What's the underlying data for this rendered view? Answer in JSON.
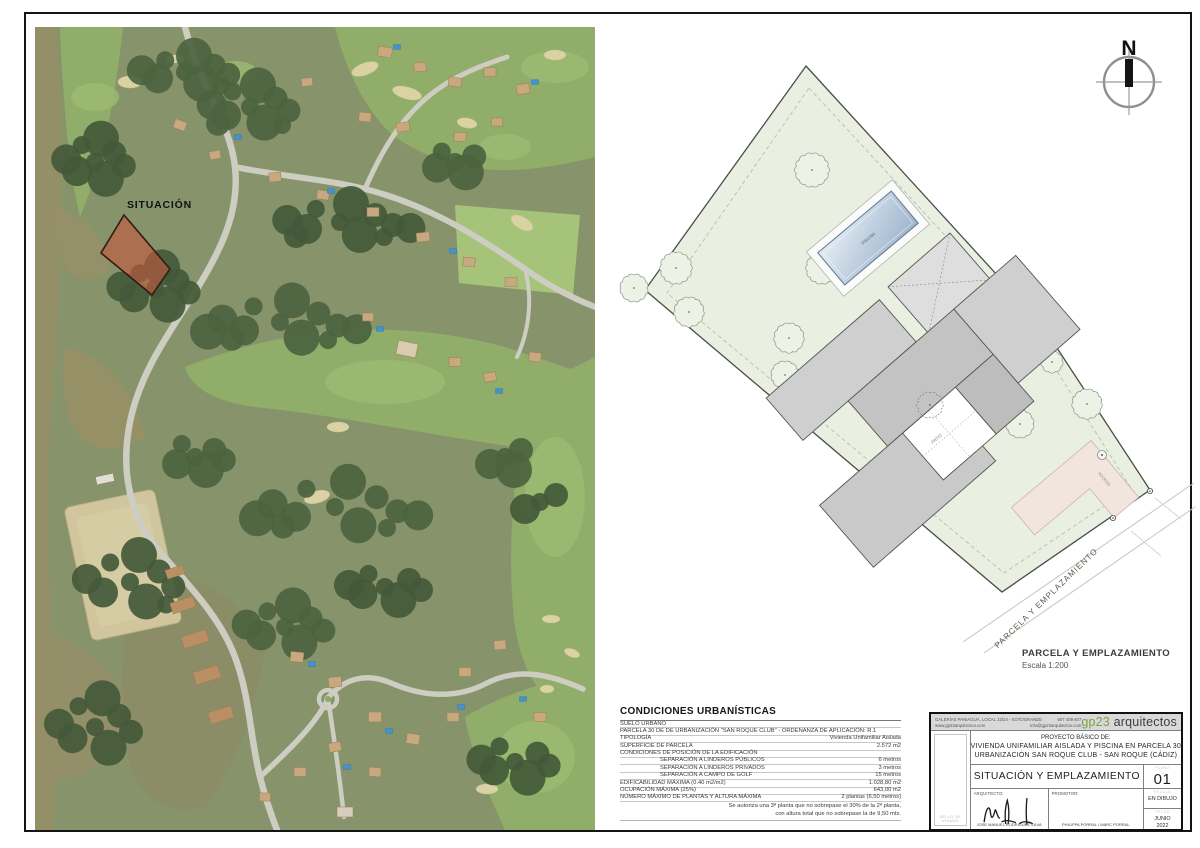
{
  "north": {
    "label": "N"
  },
  "aerial": {
    "situacion_label": "SITUACIÓN"
  },
  "plan": {
    "piscina_label": "PISCINA",
    "patio_label": "PATIO",
    "acceso_label": "ACCESO",
    "road_label": "PARCELA Y EMPLAZAMIENTO",
    "caption_title": "PARCELA Y EMPLAZAMIENTO",
    "caption_scale": "Escala 1:200"
  },
  "conditions": {
    "title": "CONDICIONES URBANÍSTICAS",
    "rows": [
      {
        "label": "SUELO URBANO",
        "value": "",
        "indent": false
      },
      {
        "label": "PARCELA 30 DE DE URBANIZACIÓN \"SAN ROQUE CLUB\"  -  ORDENANZA DE APLICACIÓN: R.1",
        "value": "",
        "indent": false
      },
      {
        "label": "TIPOLOGÍA",
        "value": "Vivienda Unifamiliar Aislada",
        "indent": false
      },
      {
        "label": "SUPERFICIE DE PARCELA",
        "value": "2.572 m2",
        "indent": false
      },
      {
        "label": "CONDICIONES DE POSICIÓN DE LA EDIFICACIÓN",
        "value": "",
        "indent": false
      },
      {
        "label": "SEPARACIÓN A LINDEROS PÚBLICOS",
        "value": "6 metros",
        "indent": true
      },
      {
        "label": "SEPARACIÓN A LINDEROS PRIVADOS",
        "value": "3 metros",
        "indent": true
      },
      {
        "label": "SEPARACIÓN A CAMPO DE GOLF",
        "value": "15 metros",
        "indent": true
      },
      {
        "label": "EDIFICABILIDAD MÁXIMA (0.40 m2/m2)",
        "value": "1.028,80 m2",
        "indent": false
      },
      {
        "label": "OCUPACIÓN MÁXIMA (25%)",
        "value": "643,00 m2",
        "indent": false
      },
      {
        "label": "NÚMERO MÁXIMO DE PLANTAS Y ALTURA MÁXIMA",
        "value": "2 plantas (6,50 metros)",
        "indent": false
      }
    ],
    "note_line1": "Se autoriza una 3ª planta que no sobrepase el 30% de la 2ª planta,",
    "note_line2": "con altura total que no sobrepase la de 9,50 mts."
  },
  "titleblock": {
    "address_line1": "GALERÍAS PANIAGUA, LOCAL 23/24  -  SOTOGRANDE",
    "phone": "607 409 607",
    "address_line2": "www.gp23arquitectos.com",
    "email": "info@gp23arquitectos.com",
    "brand_green": "gp23",
    "brand_rest": "arquitectos",
    "project_heading": "PROYECTO BÁSICO DE:",
    "project_line1": "VIVIENDA UNIFAMILIAR AISLADA Y PISCINA EN PARCELA 30",
    "project_line2": "URBANIZACIÓN SAN ROQUE CLUB - SAN ROQUE (CÁDIZ)",
    "sheet_title": "SITUACIÓN Y EMPLAZAMIENTO",
    "plano_label": "PLANO",
    "sheet_number": "01",
    "architect_label": "ARQUITECTO:",
    "architect_name": "JOSE MANUEL RODRIGUEZ SILVA",
    "promoter_label": "PROMOTOR:",
    "promoter_name": "PHILIPPA PORRAL / MARC PORRAL",
    "scale_label": "ESCALA",
    "scale_value": "EN DIBUJO",
    "date_label": "FECHA",
    "date_value_line1": "JUNIO",
    "date_value_line2": "2022",
    "sello_label": "SELLO DE VISADO"
  },
  "colors": {
    "brand_green": "#7aa23c",
    "parcel_highlight": "#c4583f",
    "plan_parcel_fill": "#e9efe1",
    "pool_fill": "#9db3cc",
    "driveway_fill": "#f2e5de",
    "building_gray": "#c9c9c9"
  }
}
